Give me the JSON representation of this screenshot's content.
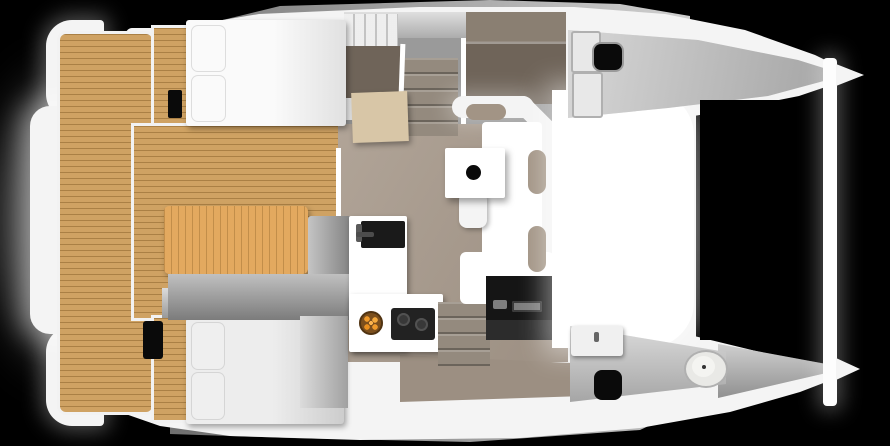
{
  "scene": {
    "title": "Catamaran top-view cutaway floor plan render",
    "view": "top-down",
    "orientation": "bows to the right, sterns to the left",
    "background": "#000000"
  },
  "palette": {
    "background": "#000000",
    "deck_white": "#f4f4f4",
    "deck_bright": "#ffffff",
    "hull_gray": "#bdbdbd",
    "hull_gray_dark": "#8e8e8e",
    "teak": "#cfa263",
    "table_wood": "#e3a95f",
    "floor_taupe": "#a99b8d",
    "walkway_taupe": "#9c8f82",
    "panel_brown": "#6f6459",
    "panel_brown_light": "#8a7f72",
    "stair_taupe": "#948a7e",
    "bed_white": "#f2f2f2",
    "bed_gray": "#dedede",
    "pillow_white": "#fafafa",
    "pillow_gray": "#efefef",
    "cushion_taupe": "#a29485",
    "bench_gray": "#a5a5a5",
    "bench_cushion_gray": "#b9b9b9",
    "cabinet_gray": "#c4c4c4",
    "wardrobe_gray": "#dedede",
    "black": "#0a0a0a",
    "dark_unit": "#151515",
    "dark_shelf": "#2c2c2c",
    "equipment_gray": "#7d7d7d",
    "cooktop_black": "#222222",
    "sink_black": "#1a1a1a",
    "bowl_brown": "#7c4f1d",
    "orange": "#f09a2b",
    "toilet_white": "#e9e9e6",
    "head_floor_gray": "#cfcfcf",
    "vanity_white": "#f0f0f0",
    "desk_wood": "#d8c6a7",
    "crossbeam_white": "#fdfdfd"
  },
  "areas": {
    "aft_cockpit": "teak cockpit with table and L-bench",
    "aft_bench": "transom bench between sterns",
    "salon": "saloon with L-sofa, dining table, stool",
    "galley": "L-shaped galley with sink, cooktop, fruit bowl",
    "nav_station": "black nav/entertainment cabinet",
    "port_aft_cabin": "double bed, white bedding, two pillows",
    "starboard_aft_cabin": "double bed, gray bedding, two pillows, deck hatch",
    "port_hull": "stairs, wardrobe, brown berth panels",
    "starboard_hull": "stairs, forward head with toilet and vanity",
    "foredeck": "bright white coachroof deck",
    "trampoline": "black netting area between bows",
    "crossbeam": "white forward crossbeam joining the bows"
  }
}
